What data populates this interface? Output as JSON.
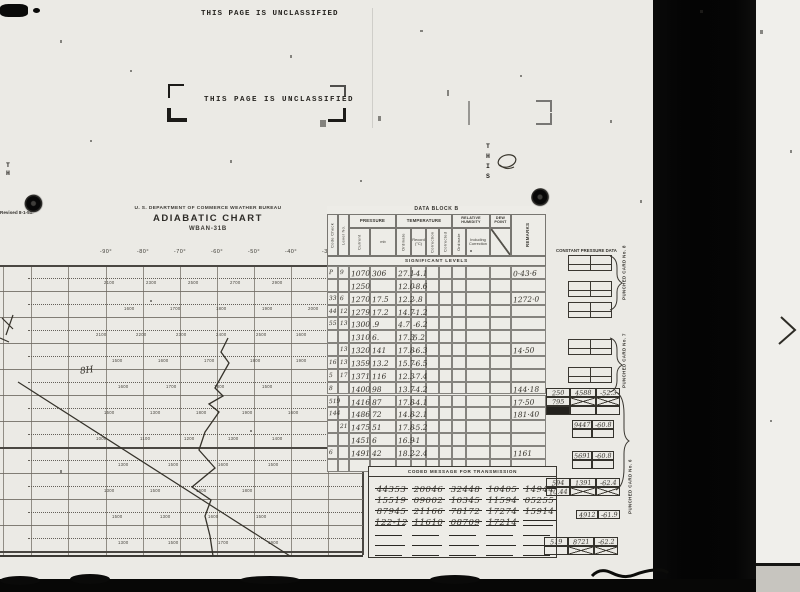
{
  "colors": {
    "paper": "#ebeae5",
    "film_black": "#050505",
    "ink": "#2c2a26",
    "handwriting": "#36332c"
  },
  "stamps": {
    "top_line": "THIS PAGE IS UNCLASSIFIED",
    "box_line": "THIS PAGE IS UNCLASSIFIED"
  },
  "margin": {
    "left_vertical": "T\nH",
    "this_vertical": "T\nH\nI\nS",
    "revised": "Revised 8-1-51:"
  },
  "header": {
    "agency": "U. S. DEPARTMENT OF COMMERCE WEATHER BUREAU",
    "title": "ADIABATIC CHART",
    "form": "WBAN-31B"
  },
  "chart": {
    "temp_labels": [
      "-90°",
      "-80°",
      "-70°",
      "-60°",
      "-50°",
      "-40°",
      "-30°"
    ],
    "handwritten_mark": "8H",
    "height_rows": [
      {
        "y": 278,
        "x0": 104,
        "step": 42,
        "values": [
          "2100",
          "2300",
          "2500",
          "2700",
          "2900"
        ]
      },
      {
        "y": 304,
        "x0": 124,
        "step": 46,
        "values": [
          "1600",
          "1700",
          "1800",
          "1900",
          "2000"
        ]
      },
      {
        "y": 330,
        "x0": 96,
        "step": 40,
        "values": [
          "2100",
          "2200",
          "2300",
          "2400",
          "2500",
          "1600"
        ]
      },
      {
        "y": 356,
        "x0": 112,
        "step": 46,
        "values": [
          "1500",
          "1600",
          "1700",
          "1800",
          "1900"
        ]
      },
      {
        "y": 382,
        "x0": 118,
        "step": 48,
        "values": [
          "1600",
          "1700",
          "1800",
          "1500"
        ]
      },
      {
        "y": 408,
        "x0": 104,
        "step": 46,
        "values": [
          "1500",
          "1300",
          "1800",
          "1900",
          "1600"
        ]
      },
      {
        "y": 434,
        "x0": 96,
        "step": 44,
        "values": [
          "1000",
          "1100",
          "1200",
          "1300",
          "1400"
        ]
      },
      {
        "y": 460,
        "x0": 118,
        "step": 50,
        "values": [
          "1300",
          "1500",
          "1600",
          "1500"
        ]
      },
      {
        "y": 486,
        "x0": 104,
        "step": 46,
        "values": [
          "1300",
          "1500",
          "1600",
          "1800"
        ]
      },
      {
        "y": 512,
        "x0": 112,
        "step": 48,
        "values": [
          "1500",
          "1300",
          "1600",
          "1500"
        ]
      },
      {
        "y": 538,
        "x0": 118,
        "step": 50,
        "values": [
          "1300",
          "1500",
          "1700",
          "1900"
        ]
      }
    ],
    "trace_points": [
      [
        228,
        338
      ],
      [
        221,
        352
      ],
      [
        229,
        363
      ],
      [
        215,
        388
      ],
      [
        223,
        396
      ],
      [
        209,
        404
      ],
      [
        219,
        412
      ],
      [
        205,
        432
      ],
      [
        199,
        450
      ],
      [
        215,
        468
      ],
      [
        192,
        487
      ],
      [
        211,
        500
      ],
      [
        205,
        516
      ],
      [
        210,
        536
      ],
      [
        213,
        556
      ]
    ],
    "ref_line": [
      [
        18,
        382
      ],
      [
        290,
        556
      ]
    ]
  },
  "data_block": {
    "title": "DATA BLOCK B",
    "groups": {
      "code_check": "Code Check",
      "level_no": "Level No.",
      "pressure": "PRESSURE",
      "temperature": "TEMPERATURE",
      "rel_humidity": "RELATIVE HUMIDITY",
      "dew_point": "DEW POINT",
      "remarks": "REMARKS"
    },
    "sub": {
      "current": "Current",
      "mb": "mb",
      "ordinate": "Ordinate",
      "record": "Record (°C)",
      "correction": "Correction",
      "corrected": "Corrected",
      "rh_ordinate": "Ordinate",
      "rh_incl": "Including Correction"
    },
    "section": "SIGNIFICANT LEVELS",
    "rows": [
      {
        "cc": "P",
        "lvl": "9",
        "p_cur": "1070",
        "p_mb": "306",
        "t_ord": "27.1",
        "t_rec": "-4.1",
        "rem": "0·43·6"
      },
      {
        "cc": "",
        "lvl": "",
        "p_cur": "1250",
        "p_mb": "",
        "t_ord": "12.0",
        "t_rec": "-8.6",
        "rem": ""
      },
      {
        "cc": "33",
        "lvl": "6",
        "p_cur": "1270",
        "p_mb": "17.5",
        "t_ord": "12.2",
        "t_rec": "-.8",
        "rem": "1272·0"
      },
      {
        "cc": "44",
        "lvl": "12",
        "p_cur": "1279",
        "p_mb": "17.2",
        "t_ord": "14.7",
        "t_rec": "-1.2",
        "rem": ""
      },
      {
        "cc": "55",
        "lvl": "13",
        "p_cur": "1300",
        "p_mb": ".9",
        "t_ord": "4.7",
        "t_rec": "-6.2",
        "rem": ""
      },
      {
        "cc": "",
        "lvl": "",
        "p_cur": "1310",
        "p_mb": "6.",
        "t_ord": "17.3",
        "t_rec": "5.2",
        "rem": ""
      },
      {
        "cc": "",
        "lvl": "13",
        "p_cur": "1320",
        "p_mb": "141",
        "t_ord": "17.8",
        "t_rec": "-6.3",
        "rem": "14·50"
      },
      {
        "cc": "16",
        "lvl": "13",
        "p_cur": "1359",
        "p_mb": "13.2",
        "t_ord": "15.7",
        "t_rec": "-6.5",
        "rem": ""
      },
      {
        "cc": "5",
        "lvl": "17",
        "p_cur": "1371",
        "p_mb": "116",
        "t_ord": "12.3",
        "t_rec": "-7.4",
        "rem": ""
      },
      {
        "cc": "8",
        "lvl": "",
        "p_cur": "1400",
        "p_mb": "98",
        "t_ord": "13.7",
        "t_rec": "-4.2",
        "rem": "144·18"
      },
      {
        "cc": "519",
        "lvl": "",
        "p_cur": "1416",
        "p_mb": "87",
        "t_ord": "17.8",
        "t_rec": "-4.1",
        "rem": "17·50"
      },
      {
        "cc": "144",
        "lvl": "",
        "p_cur": "1486",
        "p_mb": "72",
        "t_ord": "14.8",
        "t_rec": "-2.1",
        "rem": "181·40"
      },
      {
        "cc": "",
        "lvl": "21",
        "p_cur": "1475",
        "p_mb": "51",
        "t_ord": "17.8",
        "t_rec": "-5.2",
        "rem": ""
      },
      {
        "cc": "",
        "lvl": "",
        "p_cur": "1451",
        "p_mb": "6",
        "t_ord": "16.9",
        "t_rec": "-1",
        "rem": ""
      },
      {
        "cc": "6",
        "lvl": "",
        "p_cur": "1491",
        "p_mb": "42",
        "t_ord": "18.2",
        "t_rec": "-2.4",
        "rem": "1161"
      },
      {
        "cc": "",
        "lvl": "",
        "p_cur": "",
        "p_mb": "",
        "t_ord": "",
        "t_rec": "",
        "rem": ""
      }
    ]
  },
  "coded_message": {
    "title": "CODED MESSAGE FOR TRANSMISSION",
    "rows": [
      [
        "44353",
        "20046",
        "32448",
        "10405",
        "14944"
      ],
      [
        "15519",
        "09002",
        "10345",
        "11594",
        "05255"
      ],
      [
        "87945",
        "21166",
        "78172",
        "17274",
        "15914"
      ],
      [
        "122-12",
        "11610",
        "08709",
        "17214",
        ""
      ]
    ],
    "blank_rows": 4
  },
  "punched": {
    "column_title": "CONSTANT PRESSURE DATA",
    "card8": "PUNCHED CARD No. 8",
    "card7": "PUNCHED CARD No. 7",
    "card6": "PUNCHED CARD No. 6",
    "entries": [
      {
        "x": 546,
        "y": 388,
        "widths": [
          24,
          26,
          24
        ],
        "rows": [
          [
            "250",
            "4588",
            "-52.3"
          ],
          [
            "795",
            "✗",
            "✗"
          ],
          [
            "▪",
            "",
            ""
          ]
        ]
      },
      {
        "x": 572,
        "y": 420,
        "widths": [
          20,
          22
        ],
        "rows": [
          [
            "9447",
            "-60.8"
          ],
          [
            "",
            ""
          ]
        ]
      },
      {
        "x": 572,
        "y": 451,
        "widths": [
          20,
          22
        ],
        "rows": [
          [
            "5691",
            "-60.8"
          ],
          [
            "",
            ""
          ]
        ]
      },
      {
        "x": 546,
        "y": 478,
        "widths": [
          24,
          26,
          24
        ],
        "rows": [
          [
            "594",
            "1391",
            "-62.4"
          ],
          [
            "10.44",
            "✗",
            "✗"
          ]
        ]
      },
      {
        "x": 576,
        "y": 510,
        "widths": [
          22,
          22
        ],
        "rows": [
          [
            "4912",
            "-61.9"
          ]
        ]
      },
      {
        "x": 544,
        "y": 537,
        "widths": [
          24,
          26,
          24
        ],
        "rows": [
          [
            "519",
            "8721",
            "-62.2"
          ],
          [
            "",
            "✗",
            "✗"
          ]
        ]
      }
    ]
  }
}
